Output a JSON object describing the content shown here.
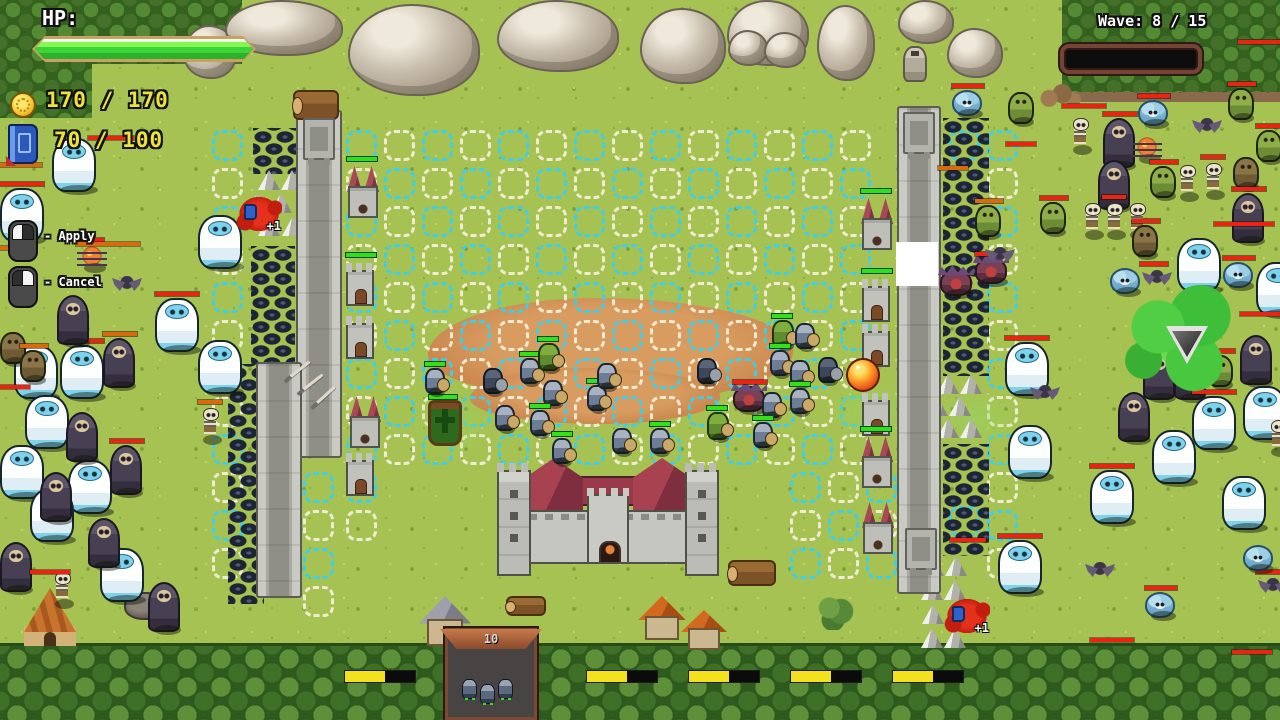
{
  "hud": {
    "hp_label": "HP:",
    "gold": "170 / 170",
    "mana": "70 / 100",
    "wave": "Wave: 8 / 15"
  },
  "hints": {
    "apply": "- Apply",
    "cancel": "- Cancel"
  },
  "panel": {
    "count": "10"
  },
  "labels": {
    "plus_one": "+1"
  },
  "colors": {
    "hp_fill": "#3bd335",
    "enemy_bar": "#ea2312",
    "damaged_bar": "#d86a10",
    "ally_bar": "#35e018",
    "grid_cyan": "#3ecfe9",
    "grid_white": "#f4efd8",
    "gold_text": "#ece23a",
    "cooldown_yellow": "#f2e11c"
  },
  "scene": {
    "grid": {
      "pitch": 38,
      "size": 31,
      "regions": [
        {
          "x": 346,
          "y": 130,
          "cols": 14,
          "rows": 9
        },
        {
          "x": 212,
          "y": 130,
          "cols": 1,
          "rows": 12
        },
        {
          "x": 303,
          "y": 472,
          "cols": 1,
          "rows": 4
        },
        {
          "x": 987,
          "y": 130,
          "cols": 1,
          "rows": 12
        },
        {
          "x": 949,
          "y": 130,
          "cols": 1,
          "rows": 1
        },
        {
          "x": 790,
          "y": 472,
          "cols": 3,
          "rows": 3
        },
        {
          "x": 346,
          "y": 472,
          "cols": 1,
          "rows": 2
        },
        {
          "x": 949,
          "y": 506,
          "cols": 1,
          "rows": 1
        }
      ]
    },
    "walls": [
      [
        296,
        110,
        46,
        348
      ],
      [
        256,
        362,
        46,
        236
      ],
      [
        897,
        106,
        44,
        488
      ]
    ],
    "fixtures": [
      [
        303,
        118
      ],
      [
        903,
        112
      ],
      [
        905,
        528
      ]
    ],
    "spikes": [
      [
        253,
        128,
        44,
        46
      ],
      [
        251,
        246,
        44,
        118
      ],
      [
        228,
        364,
        36,
        240
      ],
      [
        943,
        118,
        46,
        258
      ],
      [
        943,
        444,
        46,
        112
      ]
    ],
    "cones": [
      [
        258,
        170
      ],
      [
        281,
        170
      ],
      [
        246,
        193
      ],
      [
        270,
        193
      ],
      [
        258,
        216
      ],
      [
        282,
        216
      ],
      [
        937,
        374
      ],
      [
        960,
        374
      ],
      [
        926,
        396
      ],
      [
        949,
        396
      ],
      [
        937,
        418
      ],
      [
        960,
        418
      ],
      [
        922,
        556
      ],
      [
        945,
        556
      ],
      [
        921,
        580
      ],
      [
        944,
        580
      ],
      [
        922,
        604
      ],
      [
        945,
        604
      ],
      [
        921,
        628
      ],
      [
        944,
        628
      ]
    ],
    "towers": [
      [
        347,
        166,
        "r",
        1
      ],
      [
        346,
        262,
        "g",
        1
      ],
      [
        346,
        315,
        "g",
        0
      ],
      [
        349,
        396,
        "r",
        0
      ],
      [
        346,
        452,
        "g",
        0
      ],
      [
        861,
        198,
        "r",
        1
      ],
      [
        862,
        278,
        "g",
        1
      ],
      [
        862,
        323,
        "g",
        0
      ],
      [
        862,
        392,
        "g",
        0
      ],
      [
        861,
        436,
        "r",
        1
      ],
      [
        862,
        502,
        "r",
        0
      ]
    ],
    "banner": [
      428,
      400
    ],
    "enemies": [
      [
        "yeti",
        52,
        138,
        ""
      ],
      [
        "yeti",
        0,
        188,
        "r"
      ],
      [
        "yeti",
        198,
        215,
        ""
      ],
      [
        "yeti",
        155,
        298,
        "r"
      ],
      [
        "yeti",
        198,
        340,
        ""
      ],
      [
        "yeti",
        14,
        345,
        ""
      ],
      [
        "yeti",
        60,
        345,
        "r"
      ],
      [
        "yeti",
        25,
        395,
        ""
      ],
      [
        "yeti",
        0,
        445,
        ""
      ],
      [
        "yeti",
        68,
        460,
        ""
      ],
      [
        "yeti",
        30,
        488,
        ""
      ],
      [
        "yeti",
        100,
        548,
        ""
      ],
      [
        "reap",
        57,
        295,
        ""
      ],
      [
        "reap",
        103,
        338,
        "o"
      ],
      [
        "reap",
        66,
        412,
        ""
      ],
      [
        "reap",
        110,
        445,
        "r"
      ],
      [
        "reap",
        40,
        472,
        ""
      ],
      [
        "reap",
        88,
        518,
        ""
      ],
      [
        "reap",
        0,
        542,
        ""
      ],
      [
        "reap",
        148,
        582,
        ""
      ],
      [
        "skel",
        200,
        408,
        "o"
      ],
      [
        "skel",
        52,
        572,
        ""
      ],
      [
        "gb",
        0,
        332,
        ""
      ],
      [
        "gb",
        20,
        350,
        "o"
      ],
      [
        "bat",
        112,
        276,
        ""
      ],
      [
        "sp",
        80,
        246,
        "r"
      ],
      [
        "fl",
        952,
        90,
        "r"
      ],
      [
        "gg",
        1008,
        92,
        ""
      ],
      [
        "skel",
        1070,
        118,
        ""
      ],
      [
        "reap",
        1103,
        118,
        "r"
      ],
      [
        "fl",
        1138,
        100,
        "r"
      ],
      [
        "sp",
        1135,
        137,
        ""
      ],
      [
        "bat",
        1192,
        118,
        ""
      ],
      [
        "gg",
        1228,
        88,
        "r"
      ],
      [
        "gg",
        1256,
        130,
        "r"
      ],
      [
        "reap",
        1098,
        160,
        ""
      ],
      [
        "gg",
        1150,
        166,
        "r"
      ],
      [
        "skel",
        1177,
        165,
        ""
      ],
      [
        "skel",
        1203,
        163,
        "r"
      ],
      [
        "gb",
        1233,
        157,
        ""
      ],
      [
        "gg",
        975,
        205,
        "o"
      ],
      [
        "gg",
        1040,
        202,
        "r"
      ],
      [
        "skel",
        1082,
        203,
        ""
      ],
      [
        "skel",
        1104,
        203,
        "r"
      ],
      [
        "skel",
        1127,
        203,
        ""
      ],
      [
        "gb",
        1132,
        225,
        "r"
      ],
      [
        "yeti",
        1177,
        238,
        ""
      ],
      [
        "reap",
        1232,
        193,
        "r"
      ],
      [
        "fl",
        1110,
        268,
        ""
      ],
      [
        "bat",
        1142,
        270,
        "r"
      ],
      [
        "fl",
        1223,
        262,
        "r"
      ],
      [
        "yeti",
        1256,
        262,
        ""
      ],
      [
        "pl",
        940,
        270,
        ""
      ],
      [
        "pl",
        975,
        258,
        "r"
      ],
      [
        "bat",
        985,
        247,
        ""
      ],
      [
        "yeti",
        1005,
        342,
        "r"
      ],
      [
        "yeti",
        1008,
        425,
        ""
      ],
      [
        "reap",
        1143,
        350,
        ""
      ],
      [
        "reap",
        1174,
        350,
        "r"
      ],
      [
        "reap",
        1240,
        335,
        ""
      ],
      [
        "reap",
        1118,
        392,
        ""
      ],
      [
        "gg",
        1207,
        355,
        "r"
      ],
      [
        "yeti",
        1192,
        396,
        "r"
      ],
      [
        "yeti",
        1243,
        386,
        ""
      ],
      [
        "yeti",
        1152,
        430,
        ""
      ],
      [
        "yeti",
        1090,
        470,
        "r"
      ],
      [
        "yeti",
        1222,
        476,
        ""
      ],
      [
        "yeti",
        998,
        540,
        "r"
      ],
      [
        "bat",
        1030,
        385,
        ""
      ],
      [
        "bat",
        1085,
        562,
        ""
      ],
      [
        "bat",
        1258,
        578,
        "r"
      ],
      [
        "fl",
        1243,
        545,
        ""
      ],
      [
        "fl",
        1145,
        592,
        "r"
      ],
      [
        "pl",
        733,
        386,
        "r"
      ],
      [
        "skel",
        1268,
        420,
        ""
      ]
    ],
    "allies": [
      [
        "s",
        425,
        368,
        1
      ],
      [
        "s",
        520,
        358,
        1
      ],
      [
        "s",
        543,
        380,
        0
      ],
      [
        "s",
        495,
        405,
        0
      ],
      [
        "s",
        530,
        410,
        1
      ],
      [
        "s",
        587,
        385,
        1
      ],
      [
        "g",
        538,
        343,
        1
      ],
      [
        "s",
        597,
        363,
        0
      ],
      [
        "s",
        552,
        438,
        1
      ],
      [
        "s",
        612,
        428,
        0
      ],
      [
        "s",
        650,
        428,
        1
      ],
      [
        "d",
        483,
        368,
        0
      ],
      [
        "d",
        697,
        358,
        0
      ],
      [
        "d",
        818,
        357,
        0
      ],
      [
        "g",
        772,
        320,
        1
      ],
      [
        "s",
        795,
        323,
        0
      ],
      [
        "s",
        770,
        350,
        1
      ],
      [
        "s",
        790,
        360,
        0
      ],
      [
        "s",
        790,
        388,
        1
      ],
      [
        "s",
        762,
        392,
        0
      ],
      [
        "s",
        753,
        422,
        1
      ],
      [
        "g",
        707,
        412,
        1
      ]
    ],
    "bars": [
      [
        0,
        163,
        42,
        "o"
      ],
      [
        76,
        242,
        64,
        "o"
      ],
      [
        0,
        246,
        36,
        "o"
      ],
      [
        88,
        136,
        46,
        "r"
      ],
      [
        0,
        385,
        30,
        "r"
      ],
      [
        30,
        570,
        40,
        "r"
      ],
      [
        1062,
        104,
        44,
        "r"
      ],
      [
        1238,
        40,
        42,
        "r"
      ],
      [
        1006,
        142,
        30,
        "r"
      ],
      [
        1214,
        222,
        60,
        "r"
      ],
      [
        938,
        166,
        30,
        "o"
      ],
      [
        1240,
        312,
        40,
        "r"
      ],
      [
        950,
        538,
        36,
        "r"
      ],
      [
        1090,
        638,
        44,
        "r"
      ],
      [
        1232,
        650,
        40,
        "r"
      ]
    ],
    "splats": [
      [
        236,
        194
      ],
      [
        944,
        596
      ]
    ],
    "fireball": [
      846,
      358,
      34
    ],
    "cursor": [
      896,
      242,
      42,
      44
    ],
    "cloud": {
      "x": 1122,
      "y": 282,
      "w": 120,
      "h": 112,
      "tri": [
        1166,
        326
      ]
    },
    "auras": [
      [
        408,
        392,
        84,
        66
      ],
      [
        826,
        380,
        92,
        62
      ],
      [
        930,
        388,
        92,
        62
      ]
    ],
    "arrows": [
      [
        281,
        370,
        -38
      ],
      [
        294,
        383,
        -38
      ],
      [
        307,
        396,
        -42
      ]
    ],
    "boulders": [
      [
        183,
        25,
        54,
        54
      ],
      [
        225,
        0,
        118,
        56
      ],
      [
        348,
        4,
        132,
        92
      ],
      [
        497,
        0,
        122,
        72
      ],
      [
        640,
        8,
        86,
        76
      ],
      [
        727,
        0,
        82,
        66
      ],
      [
        728,
        30,
        40,
        36
      ],
      [
        764,
        32,
        42,
        36
      ],
      [
        817,
        5,
        58,
        76
      ],
      [
        898,
        0,
        56,
        44
      ],
      [
        947,
        28,
        56,
        50
      ]
    ],
    "decor": [
      [
        "log",
        293,
        90,
        46,
        30
      ],
      [
        "log",
        728,
        560,
        48,
        26
      ],
      [
        "log",
        506,
        596,
        40,
        20
      ],
      [
        "rockpile",
        1038,
        84,
        44,
        24
      ],
      [
        "statue",
        903,
        46,
        24,
        36
      ],
      [
        "tent",
        24,
        588,
        52,
        58
      ],
      [
        "rock",
        124,
        592,
        42,
        28
      ],
      [
        "houseG",
        422,
        596,
        46,
        50
      ],
      [
        "houseO",
        641,
        596,
        42,
        44
      ],
      [
        "houseO",
        684,
        610,
        40,
        40
      ],
      [
        "bush",
        816,
        596,
        38,
        34
      ]
    ],
    "ybars": [
      [
        344,
        670
      ],
      [
        586,
        670
      ],
      [
        688,
        670
      ],
      [
        790,
        670
      ],
      [
        892,
        670
      ]
    ]
  }
}
